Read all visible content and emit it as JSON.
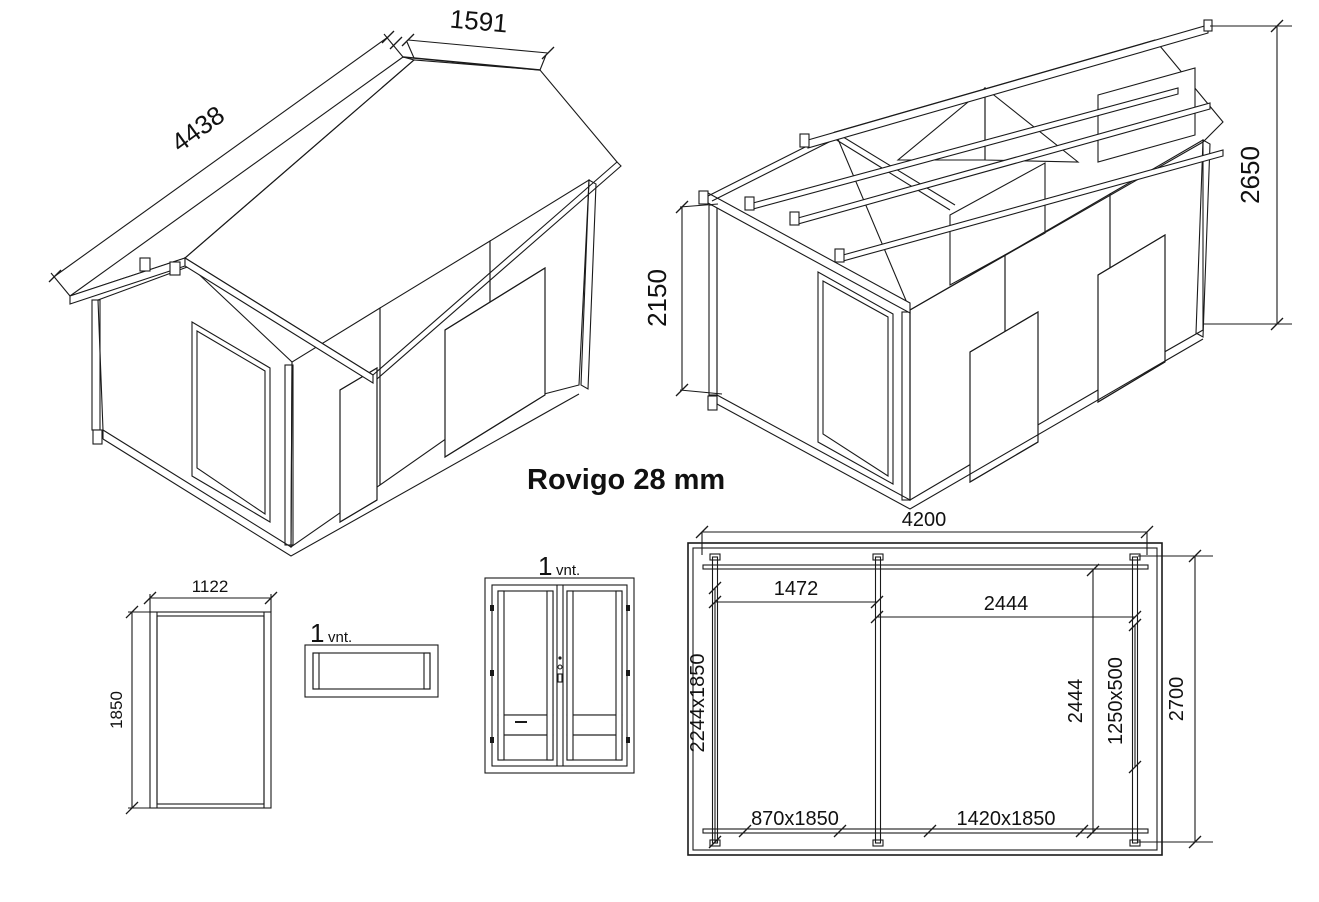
{
  "title": "Rovigo 28 mm",
  "colors": {
    "line": "#1a1a1a",
    "background": "#ffffff"
  },
  "iso_roof_view": {
    "description": "assembled cabin with roof",
    "dim_roof_length": "4438",
    "dim_roof_slope": "1591"
  },
  "iso_frame_view": {
    "description": "cabin frame without roof boards",
    "dim_wall_height": "2150",
    "dim_ridge_height": "2650"
  },
  "window_panel": {
    "dim_width": "1122",
    "dim_height": "1850"
  },
  "small_window": {
    "quantity": "1",
    "unit": "vnt."
  },
  "double_door": {
    "quantity": "1",
    "unit": "vnt."
  },
  "floor_plan": {
    "dim_total_length": "4200",
    "dim_bay_left": "1472",
    "dim_bay_right": "2444",
    "dim_opening_left_wall": "2244x1850",
    "dim_inner_length": "2444",
    "dim_window": "1250x500",
    "dim_total_width": "2700",
    "dim_door_single": "870x1850",
    "dim_door_double": "1420x1850"
  }
}
